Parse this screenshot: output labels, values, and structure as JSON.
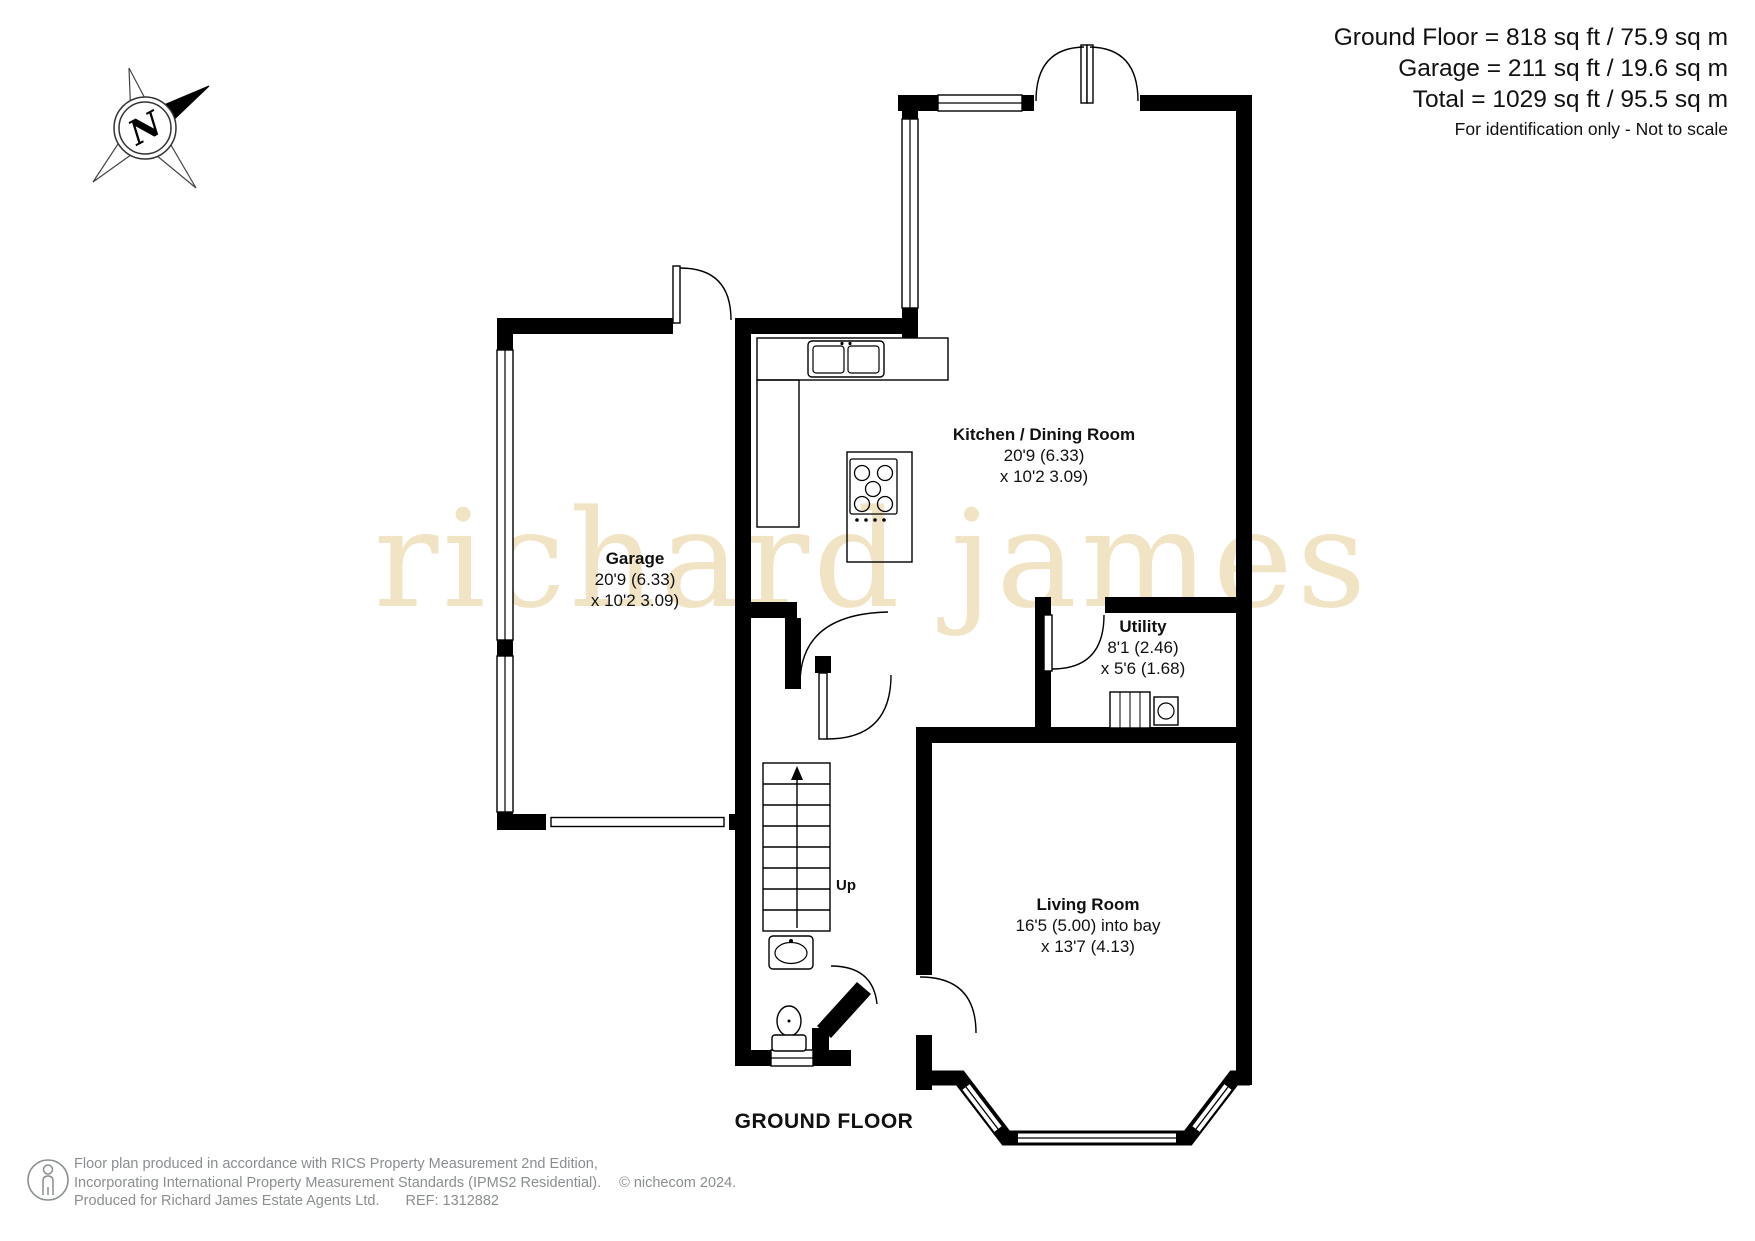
{
  "header": {
    "area_lines": [
      "Ground Floor = 818 sq ft / 75.9 sq m",
      "Garage = 211 sq ft / 19.6 sq m",
      "Total = 1029 sq ft / 95.5 sq m"
    ],
    "disclaimer": "For identification only - Not to scale"
  },
  "compass": {
    "label": "N"
  },
  "watermark": "richard james",
  "floor_label": "GROUND FLOOR",
  "rooms": {
    "kitchen": {
      "name": "Kitchen / Dining Room",
      "dim1": "20'9 (6.33)",
      "dim2": "x 10'2 3.09)"
    },
    "garage": {
      "name": "Garage",
      "dim1": "20'9 (6.33)",
      "dim2": "x 10'2 3.09)"
    },
    "utility": {
      "name": "Utility",
      "dim1": "8'1 (2.46)",
      "dim2": "x 5'6 (1.68)"
    },
    "living": {
      "name": "Living Room",
      "dim1": "16'5 (5.00) into bay",
      "dim2": "x 13'7 (4.13)"
    }
  },
  "stairs": {
    "label": "Up"
  },
  "footer": {
    "line1": "Floor plan produced in accordance with RICS Property Measurement 2nd Edition,",
    "line2": "Incorporating International Property Measurement Standards (IPMS2 Residential).",
    "copyright": "© nichecom 2024.",
    "line3a": "Produced for Richard James Estate Agents Ltd.",
    "line3b": "REF: 1312882"
  },
  "colors": {
    "wall": "#000000",
    "watermark": "#f1e4c4",
    "footer_text": "#8a8e90"
  }
}
